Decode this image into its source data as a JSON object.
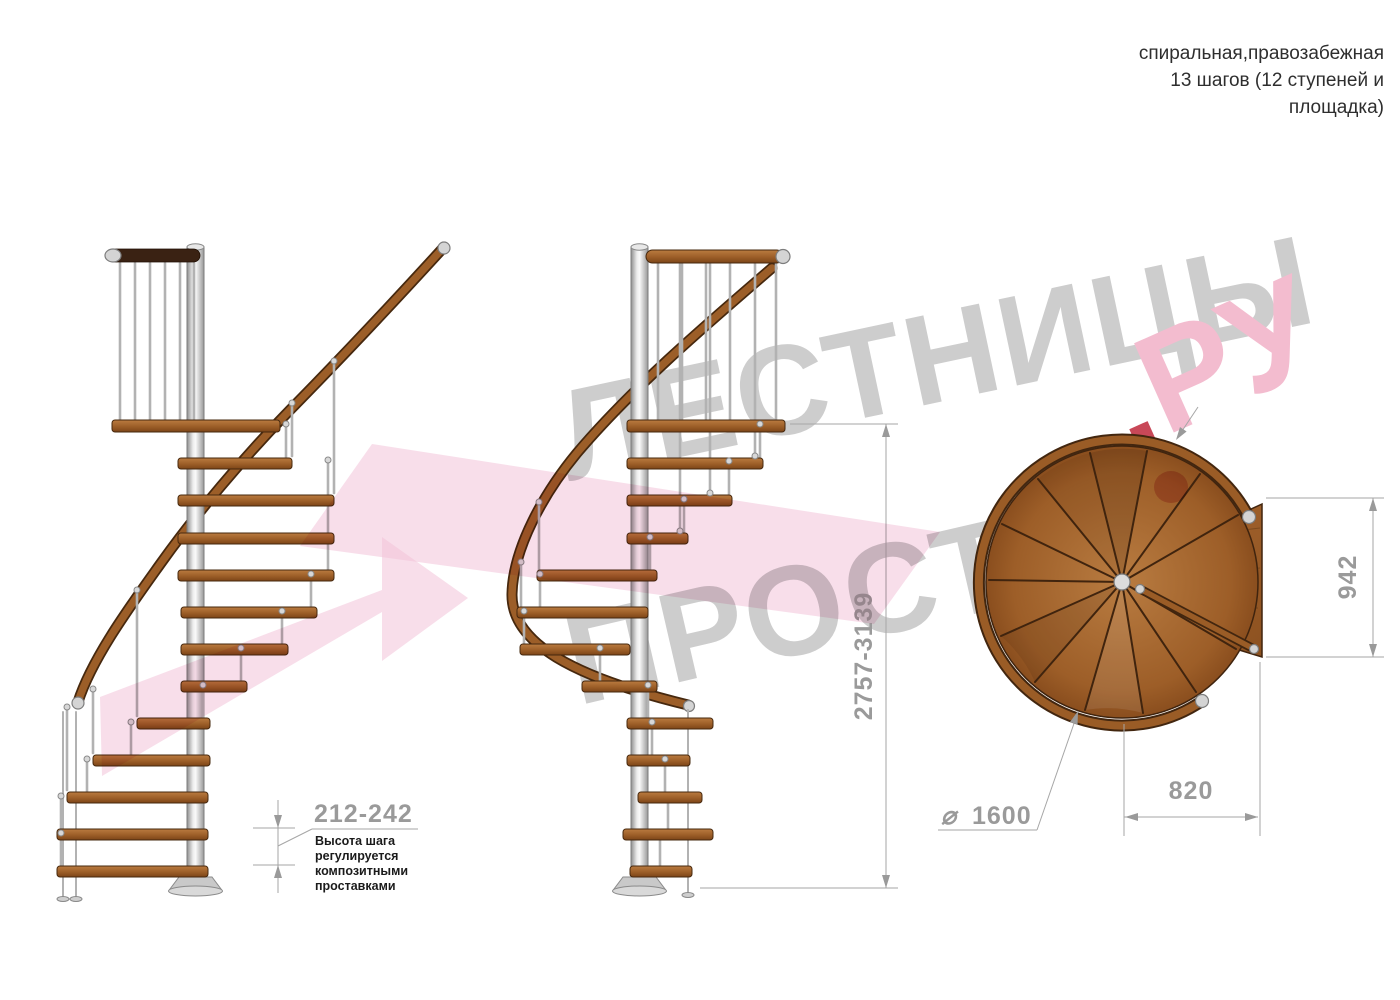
{
  "header": {
    "line1": "спиральная,правозабежная",
    "line2": "13 шагов (12 ступеней и",
    "line3": "площадка)"
  },
  "watermark": {
    "line1": "ЛЕСТНИЦЫ",
    "line2": "ПРОСТО",
    "dot": ".",
    "suffix": "РУ"
  },
  "dimensions": {
    "step_height": "212-242",
    "step_height_note": "Высота шага\nрегулируется\nкомпозитными\nпроставками",
    "total_height": "2757-3139",
    "landing_depth": "942",
    "landing_length": "820",
    "diameter_symbol": "⌀",
    "diameter": "1600"
  },
  "colors": {
    "wood": "#9c5e28",
    "wood_dark": "#46280e",
    "metal": "#d4d4d4",
    "dim_gray": "#9a9a9a",
    "watermark_gray": "#cdcdcd",
    "watermark_pink": "#f3bccf",
    "watermark_red": "#c84858",
    "arrow_pink": "#f2c3d8"
  }
}
